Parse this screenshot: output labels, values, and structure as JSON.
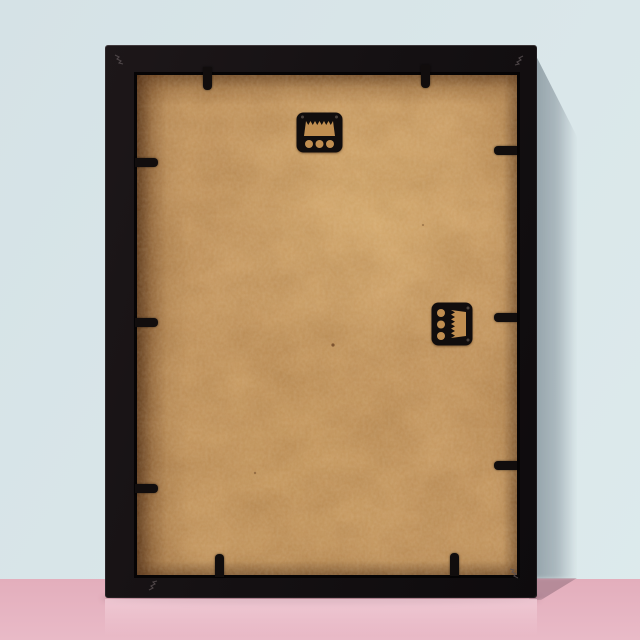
{
  "meta": {
    "type": "product-photo",
    "subject": "Back view of an empty black picture frame standing upright on a pink surface against a pale blue wall",
    "text_content": "none"
  },
  "frame": {
    "style": "black box frame, rear view",
    "backing": "tan MDF hardboard panel",
    "orientation": "portrait"
  },
  "hardware": {
    "hangers": [
      {
        "name": "sawtooth-hanger-top",
        "position": "top center",
        "holes": 3,
        "orientation": "horizontal"
      },
      {
        "name": "sawtooth-hanger-side",
        "position": "right middle",
        "holes": 3,
        "orientation": "vertical"
      }
    ],
    "clips": {
      "count": 10,
      "top": 2,
      "bottom": 2,
      "left": 3,
      "right": 3
    },
    "corner_fasteners": 4
  },
  "colors": {
    "wall": "#d5e2e6",
    "wall-hi": "#ddeaec",
    "wall-shadow": "#a9b4ba",
    "floor": "#e3aebc",
    "floor-deep": "#e9bac7",
    "floor-shadow": "#ae8593",
    "frame": "#151113",
    "board": "#c99b62",
    "board-mid": "#c08e51",
    "hw": "#110d0d",
    "reflection": "#f3d0da",
    "vnail-stroke": "#5b5254"
  }
}
